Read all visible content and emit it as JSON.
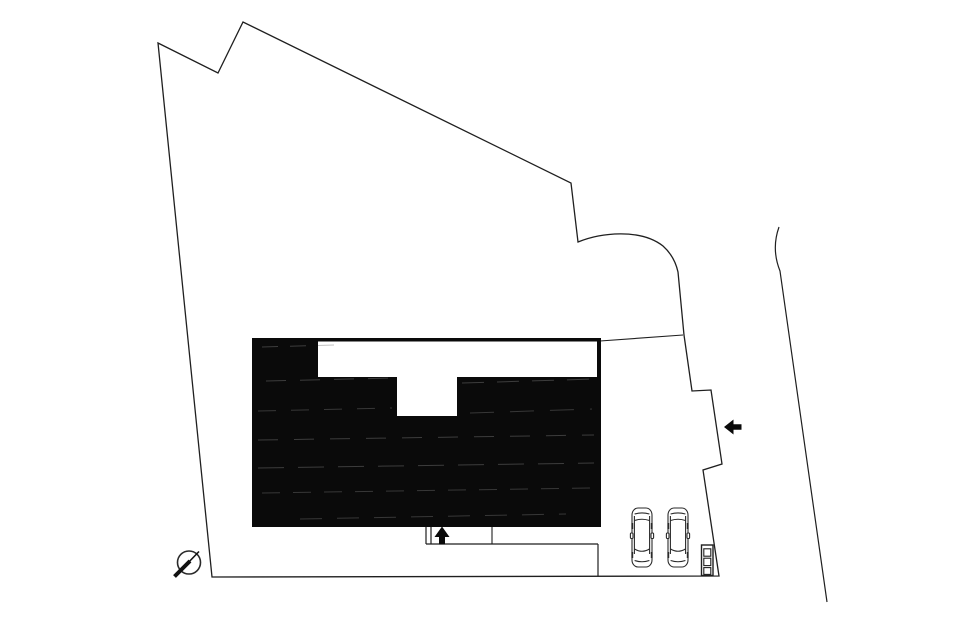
{
  "canvas": {
    "width": 965,
    "height": 629,
    "background_color": "#ffffff",
    "line_color": "#1f1f1f",
    "fill_color": "#0a0a0a"
  },
  "site_plan": {
    "description": "architectural site plan drawing",
    "shapes": [
      {
        "name": "site-boundary-line",
        "tag": "path",
        "interactable": false,
        "attrs": {
          "d": "M 158 43 L 218 73 L 243 22 L 571 183 L 578 242 C 600 233 640 228 663 246 C 672 254 676 263 678 272 L 684 335 L 692 391 L 711 390 L 722 464 L 703 470 L 719 576 L 212 577 Z",
          "fill": "none",
          "stroke": "#1f1f1f",
          "stroke-width": "1.3",
          "stroke-linejoin": "miter"
        }
      },
      {
        "name": "road-edge-line",
        "tag": "path",
        "interactable": false,
        "attrs": {
          "d": "M 779 227 C 774 241 774 256 780 271 L 827 602",
          "fill": "none",
          "stroke": "#1f1f1f",
          "stroke-width": "1.2"
        }
      },
      {
        "name": "boundary-connector-line",
        "tag": "line",
        "interactable": false,
        "attrs": {
          "x1": "600",
          "y1": "341",
          "x2": "683",
          "y2": "335",
          "stroke": "#1f1f1f",
          "stroke-width": "1.1"
        }
      },
      {
        "name": "building-footprint",
        "tag": "rect",
        "interactable": false,
        "attrs": {
          "x": "252",
          "y": "338",
          "width": "349",
          "height": "189",
          "fill": "#0a0a0a"
        }
      },
      {
        "name": "building-notch-top",
        "tag": "rect",
        "interactable": false,
        "attrs": {
          "x": "318",
          "y": "341.5",
          "width": "279",
          "height": "35.5",
          "fill": "#ffffff"
        }
      },
      {
        "name": "building-notch-stem",
        "tag": "rect",
        "interactable": false,
        "attrs": {
          "x": "397",
          "y": "377",
          "width": "60",
          "height": "39",
          "fill": "#ffffff"
        }
      },
      {
        "name": "fill-streak",
        "tag": "line",
        "interactable": false,
        "attrs": {
          "x1": "262",
          "y1": "347",
          "x2": "334",
          "y2": "345",
          "stroke": "#7a7a7a",
          "stroke-width": "1",
          "opacity": "0.45",
          "stroke-dasharray": "16 12"
        }
      },
      {
        "name": "fill-streak",
        "tag": "line",
        "interactable": false,
        "attrs": {
          "x1": "266",
          "y1": "381",
          "x2": "392",
          "y2": "378",
          "stroke": "#7a7a7a",
          "stroke-width": "1",
          "opacity": "0.45",
          "stroke-dasharray": "20 14"
        }
      },
      {
        "name": "fill-streak",
        "tag": "line",
        "interactable": false,
        "attrs": {
          "x1": "462",
          "y1": "383",
          "x2": "594",
          "y2": "379",
          "stroke": "#7a7a7a",
          "stroke-width": "1",
          "opacity": "0.45",
          "stroke-dasharray": "22 13"
        }
      },
      {
        "name": "fill-streak",
        "tag": "line",
        "interactable": false,
        "attrs": {
          "x1": "258",
          "y1": "411",
          "x2": "392",
          "y2": "408",
          "stroke": "#7a7a7a",
          "stroke-width": "1",
          "opacity": "0.4",
          "stroke-dasharray": "18 15"
        }
      },
      {
        "name": "fill-streak",
        "tag": "line",
        "interactable": false,
        "attrs": {
          "x1": "470",
          "y1": "413",
          "x2": "592",
          "y2": "409",
          "stroke": "#7a7a7a",
          "stroke-width": "1",
          "opacity": "0.4",
          "stroke-dasharray": "24 16"
        }
      },
      {
        "name": "fill-streak",
        "tag": "line",
        "interactable": false,
        "attrs": {
          "x1": "258",
          "y1": "440",
          "x2": "594",
          "y2": "435",
          "stroke": "#7a7a7a",
          "stroke-width": "1",
          "opacity": "0.45",
          "stroke-dasharray": "20 16"
        }
      },
      {
        "name": "fill-streak",
        "tag": "line",
        "interactable": false,
        "attrs": {
          "x1": "258",
          "y1": "468",
          "x2": "594",
          "y2": "463",
          "stroke": "#7a7a7a",
          "stroke-width": "1",
          "opacity": "0.45",
          "stroke-dasharray": "26 14"
        }
      },
      {
        "name": "fill-streak",
        "tag": "line",
        "interactable": false,
        "attrs": {
          "x1": "262",
          "y1": "493",
          "x2": "592",
          "y2": "488",
          "stroke": "#7a7a7a",
          "stroke-width": "1",
          "opacity": "0.4",
          "stroke-dasharray": "18 13"
        }
      },
      {
        "name": "fill-streak",
        "tag": "line",
        "interactable": false,
        "attrs": {
          "x1": "300",
          "y1": "519",
          "x2": "566",
          "y2": "514",
          "stroke": "#7a7a7a",
          "stroke-width": "1",
          "opacity": "0.4",
          "stroke-dasharray": "22 15"
        }
      },
      {
        "name": "entrance-gate-line-a",
        "tag": "line",
        "interactable": false,
        "attrs": {
          "x1": "426",
          "y1": "527",
          "x2": "426",
          "y2": "544",
          "stroke": "#1f1f1f",
          "stroke-width": "1.2"
        }
      },
      {
        "name": "entrance-gate-line-b",
        "tag": "line",
        "interactable": false,
        "attrs": {
          "x1": "431",
          "y1": "527",
          "x2": "431",
          "y2": "544",
          "stroke": "#1f1f1f",
          "stroke-width": "1.2"
        }
      },
      {
        "name": "approach-line",
        "tag": "line",
        "interactable": false,
        "attrs": {
          "x1": "426",
          "y1": "544",
          "x2": "598",
          "y2": "544",
          "stroke": "#1f1f1f",
          "stroke-width": "1.2"
        }
      },
      {
        "name": "parking-divider-line",
        "tag": "line",
        "interactable": false,
        "attrs": {
          "x1": "492",
          "y1": "527",
          "x2": "492",
          "y2": "544",
          "stroke": "#1f1f1f",
          "stroke-width": "1.1"
        }
      },
      {
        "name": "parking-edge-line",
        "tag": "line",
        "interactable": false,
        "attrs": {
          "x1": "598",
          "y1": "544",
          "x2": "598",
          "y2": "576",
          "stroke": "#1f1f1f",
          "stroke-width": "1.2"
        }
      },
      {
        "name": "entrance-arrow-up",
        "tag": "polygon",
        "interactable": false,
        "attrs": {
          "points": "442,526.5 434.5,537 439,537 439,544.5 445,544.5 445,537 449.5,537",
          "fill": "#0a0a0a"
        }
      },
      {
        "name": "site-access-arrow-left",
        "tag": "polygon",
        "interactable": false,
        "attrs": {
          "points": "724,427 733.5,419.5 733.5,424.2 741.5,424.2 741.5,429.8 733.5,429.8 733.5,434.5",
          "fill": "#0a0a0a"
        }
      },
      {
        "name": "utility-pole-circle",
        "tag": "circle",
        "interactable": false,
        "attrs": {
          "cx": "189",
          "cy": "562.5",
          "r": "11.5",
          "fill": "none",
          "stroke": "#2a2a2a",
          "stroke-width": "1.6"
        }
      },
      {
        "name": "utility-pole-slash-thick",
        "tag": "line",
        "interactable": false,
        "attrs": {
          "x1": "174.5",
          "y1": "576.5",
          "x2": "190",
          "y2": "561",
          "stroke": "#111111",
          "stroke-width": "4"
        }
      },
      {
        "name": "utility-pole-slash-thin",
        "tag": "line",
        "interactable": false,
        "attrs": {
          "x1": "185",
          "y1": "566",
          "x2": "199",
          "y2": "551.5",
          "stroke": "#111111",
          "stroke-width": "1.6"
        }
      },
      {
        "name": "meter-box",
        "tag": "rect",
        "interactable": false,
        "attrs": {
          "x": "701.5",
          "y": "545",
          "width": "11.5",
          "height": "30.5",
          "fill": "#ffffff",
          "stroke": "#1f1f1f",
          "stroke-width": "1.4"
        }
      },
      {
        "name": "meter-box-cell",
        "tag": "rect",
        "interactable": false,
        "attrs": {
          "x": "703.8",
          "y": "548.8",
          "width": "7",
          "height": "7.4",
          "fill": "none",
          "stroke": "#1f1f1f",
          "stroke-width": "1.1"
        }
      },
      {
        "name": "meter-box-cell",
        "tag": "rect",
        "interactable": false,
        "attrs": {
          "x": "703.8",
          "y": "558.2",
          "width": "7",
          "height": "7.4",
          "fill": "none",
          "stroke": "#1f1f1f",
          "stroke-width": "1.1"
        }
      },
      {
        "name": "meter-box-cell",
        "tag": "rect",
        "interactable": false,
        "attrs": {
          "x": "703.8",
          "y": "567.6",
          "width": "7",
          "height": "6.8",
          "fill": "none",
          "stroke": "#1f1f1f",
          "stroke-width": "1.1"
        }
      },
      {
        "name": "parked-car",
        "tag": "use",
        "interactable": false,
        "attrs": {
          "href": "#car-symbol",
          "x": "630",
          "y": "507"
        }
      },
      {
        "name": "parked-car",
        "tag": "use",
        "interactable": false,
        "attrs": {
          "href": "#car-symbol",
          "x": "666",
          "y": "507"
        }
      }
    ]
  }
}
